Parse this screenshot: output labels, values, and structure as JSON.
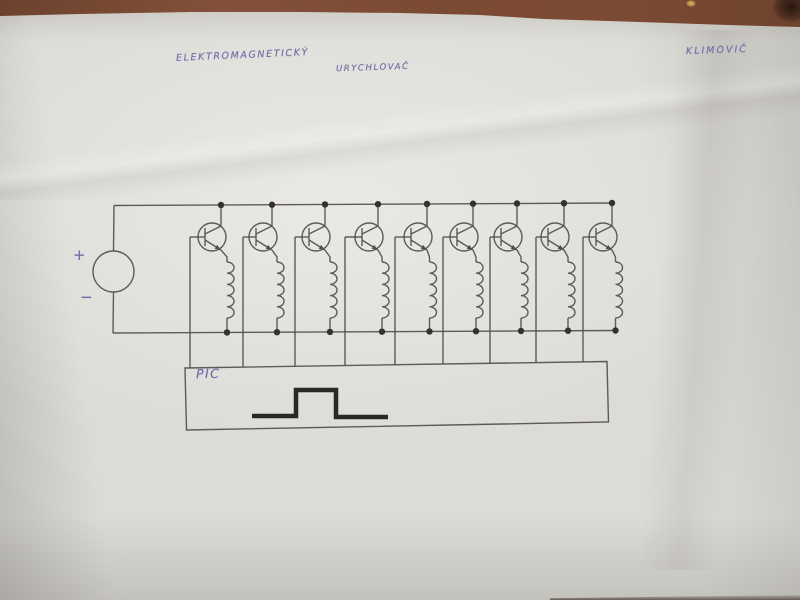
{
  "photo": {
    "description": "Photograph of a hand-drawn electronic schematic in pencil on a white paper sheet lying on a reddish-brown wooden surface",
    "colors": {
      "wood": "#7b4a33",
      "wood_dark_mark": "#2a1a12",
      "paper": "#dcdbd6",
      "pencil": "#514f4b",
      "junction_dot": "#34322e",
      "ink_blue": "#6b6da6",
      "pulse_stroke": "#2a2826"
    }
  },
  "annotations": {
    "title_line1": "ELEKTROMAGNETICKÝ",
    "title_line2": "URYCHLOVAČ",
    "author": "KLIMOVIČ",
    "source_plus": "+",
    "source_minus": "−",
    "pic_label": "PIC"
  },
  "circuit": {
    "type": "schematic",
    "description": "DC source feeding a top and bottom supply rail; nine parallel stages, each an NPN transistor in series with a coil between the rails; each transistor base is wired down to a PIC controller box that outputs a square pulse",
    "stage_count": 9,
    "source": {
      "cx": 113.5,
      "cy": 271.5,
      "r": 20.5
    },
    "rails": {
      "top": [
        114,
        205.5,
        613,
        203
      ],
      "bottom": [
        113,
        333,
        616,
        330.5
      ]
    },
    "transistor": {
      "cy": 237,
      "r": 14
    },
    "coil": {
      "top_y": 262,
      "loops": 5,
      "loop_h": 11.2,
      "loop_rx": 7
    },
    "stages": [
      {
        "base_x": 190,
        "center_x": 212,
        "collector_x": 221,
        "coil_x": 227
      },
      {
        "base_x": 243,
        "center_x": 263,
        "collector_x": 272,
        "coil_x": 277
      },
      {
        "base_x": 295,
        "center_x": 316,
        "collector_x": 325,
        "coil_x": 330
      },
      {
        "base_x": 345,
        "center_x": 369,
        "collector_x": 378,
        "coil_x": 382
      },
      {
        "base_x": 395,
        "center_x": 418,
        "collector_x": 427,
        "coil_x": 429.5
      },
      {
        "base_x": 443,
        "center_x": 464,
        "collector_x": 473,
        "coil_x": 476
      },
      {
        "base_x": 490,
        "center_x": 508,
        "collector_x": 517,
        "coil_x": 521
      },
      {
        "base_x": 536,
        "center_x": 555,
        "collector_x": 564,
        "coil_x": 568
      },
      {
        "base_x": 583,
        "center_x": 603,
        "collector_x": 612,
        "coil_x": 615.5
      }
    ],
    "pic_box": {
      "points": [
        [
          185,
          368
        ],
        [
          607,
          361.5
        ],
        [
          608.5,
          422
        ],
        [
          186.5,
          430
        ]
      ]
    },
    "pulse": {
      "points": [
        [
          252,
          416
        ],
        [
          296,
          416
        ],
        [
          296,
          390
        ],
        [
          336,
          390
        ],
        [
          336,
          417
        ],
        [
          388,
          417
        ]
      ],
      "stroke_width": 4.5
    },
    "line_width": 1.4,
    "dot_r": 3.2
  }
}
